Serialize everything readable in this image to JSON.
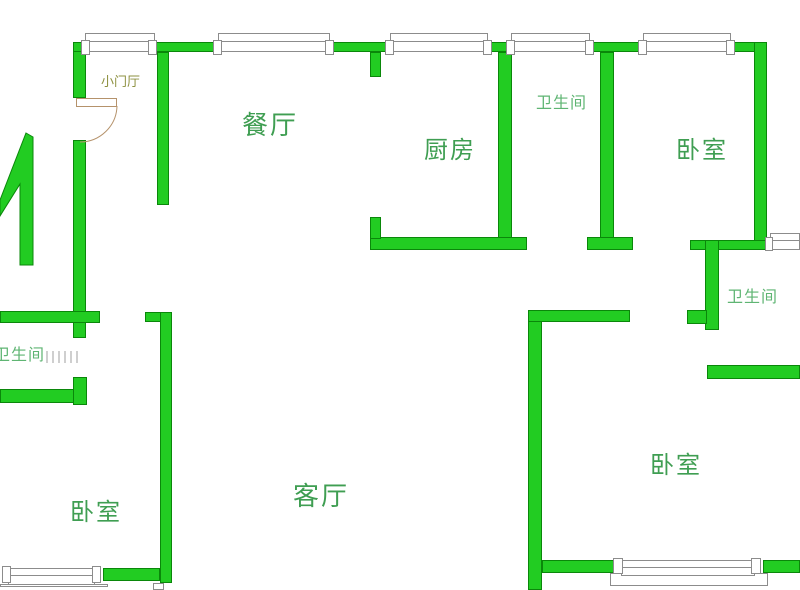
{
  "floor_plan": {
    "rooms": {
      "foyer": "小门厅",
      "dining": "餐厅",
      "kitchen": "厨房",
      "bathroom_top": "卫生间",
      "bedroom_top_right": "卧室",
      "bathroom_right": "卫生间",
      "bathroom_left": "卫生间",
      "bedroom_bottom_left": "卧室",
      "living": "客厅",
      "bedroom_bottom_right": "卧室"
    },
    "colors": {
      "wall_fill": "#22cc22",
      "wall_outline": "#0a870a",
      "window_line": "#8c8c8c",
      "door_arc": "#b5926b",
      "label_large": "#3f9e52",
      "label_small": "#5fb573",
      "label_foyer": "#8e9141",
      "background": "#ffffff"
    }
  }
}
